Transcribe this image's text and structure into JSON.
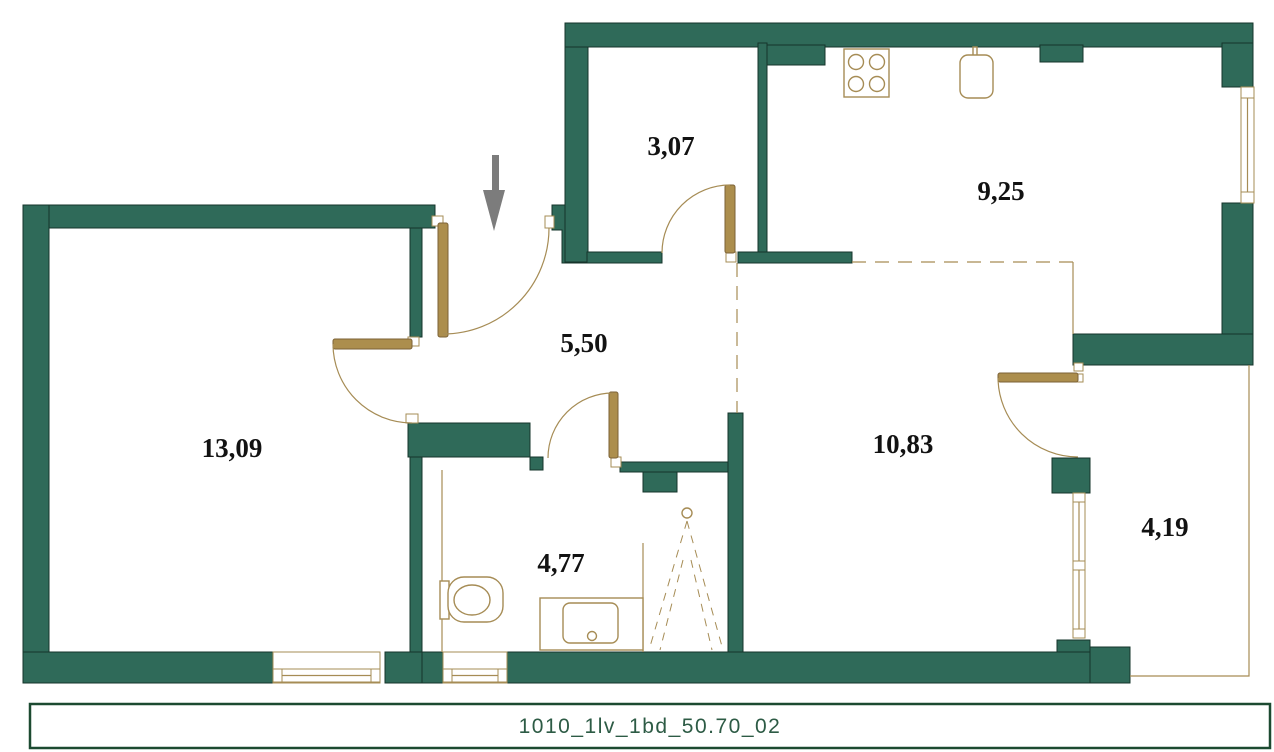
{
  "plan": {
    "entrance_arrow": "entrance",
    "rooms": [
      {
        "name": "storage",
        "area": "3,07"
      },
      {
        "name": "kitchen",
        "area": "9,25"
      },
      {
        "name": "hallway",
        "area": "5,50"
      },
      {
        "name": "living-room",
        "area": "13,09"
      },
      {
        "name": "bedroom",
        "area": "10,83"
      },
      {
        "name": "bathroom",
        "area": "4,77"
      },
      {
        "name": "balcony",
        "area": "4,19"
      }
    ],
    "fixtures": [
      "stove-icon",
      "kitchen-sink-icon",
      "toilet-icon",
      "washbasin-icon",
      "shower-icon",
      "entrance-arrow-icon"
    ],
    "colors": {
      "wall": "#2F6A59",
      "joinery": "#AC8E4D",
      "lines": "#A68C55",
      "label": "#121212",
      "arrow": "#7C7C7C",
      "title": "#2D5B45",
      "title_border": "#1C4A31"
    }
  },
  "title_block": {
    "label": "1010_1lv_1bd_50.70_02"
  }
}
